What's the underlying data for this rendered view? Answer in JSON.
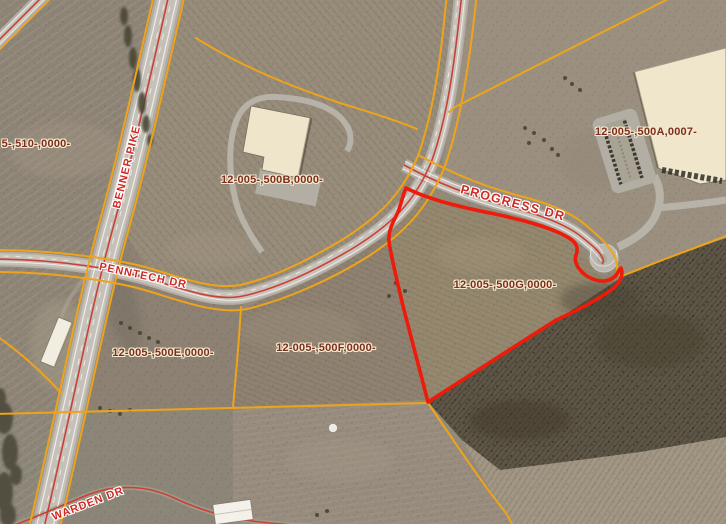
{
  "map_labels": {
    "roads": [
      {
        "text": "BENNER PIKE"
      },
      {
        "text": "PENNTECH DR"
      },
      {
        "text": "PROGRESS DR"
      },
      {
        "text": "WARDEN DR"
      }
    ],
    "parcels": [
      {
        "text": "5-,510-,0000-"
      },
      {
        "text": "12-005-,500B,0000-"
      },
      {
        "text": "12-005-,500A,0007-"
      },
      {
        "text": "12-005-,500G,0000-"
      },
      {
        "text": "12-005-,500E,0000-"
      },
      {
        "text": "12-005-,500F,0000-"
      }
    ]
  },
  "selection": {
    "highlighted_parcel": "12-005-,500G,0000-"
  },
  "colors": {
    "parcel_line": "#eea41a",
    "selection_outline": "#ee1b0b",
    "road_centerline": "#c94136",
    "road_label": "#ce2b24",
    "road_label_halo": "#ffffff",
    "parcel_label": "#7c2f1d",
    "parcel_label_halo": "#f3e9cf"
  }
}
